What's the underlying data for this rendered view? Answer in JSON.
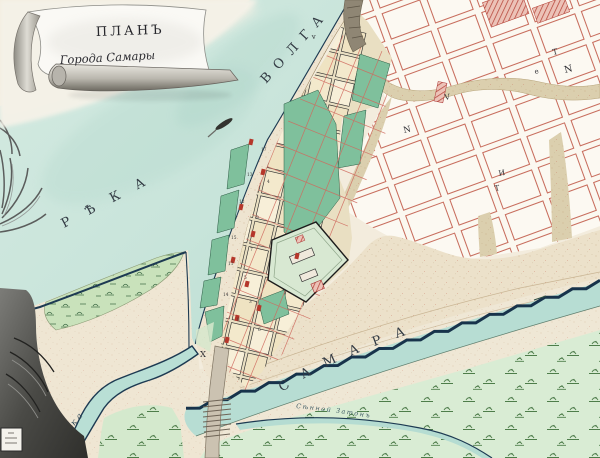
{
  "cartouche": {
    "title": "ПЛАНЪ",
    "subtitle": "Города Самары"
  },
  "labels": {
    "river_left_word": "РѢКА",
    "river_left_word2": "ВОЛГА",
    "river_bottom": "САМАРА",
    "channel_small": "рѣка",
    "backwater": "Сѣнной Затонъ"
  },
  "plot_letters": {
    "l1": "N",
    "l2": "Т",
    "l3": "е",
    "l4": "И",
    "l5": "Т",
    "l6": "N",
    "l7": "V",
    "l8": "v",
    "l9": "X"
  },
  "block_numbers": {
    "n1": "17",
    "n2": "13",
    "n3": "4",
    "n4": "12",
    "n5": "9",
    "n6": "15",
    "n7": "7",
    "n8": "11",
    "n9": "5",
    "n10": "14",
    "n11": "3",
    "n12": "8",
    "n13": "6"
  },
  "colors": {
    "paper": "#f3ecdd",
    "water": "#c8e4da",
    "water_deep": "#aed6ca",
    "bank_ink": "#1d3a52",
    "sand": "#eee4d0",
    "speckle": "#b98e63",
    "city_block": "#f5ecd3",
    "garden_green": "#7fc09c",
    "meadow": "#d9ecd4",
    "marsh": "#c9e2bb",
    "tuft_green": "#4e7d4a",
    "plan_red": "#c86e5e",
    "building_red": "#b5372b",
    "ravine": "#dbcfae",
    "road": "#cbc2b1",
    "ink": "#2e2e33"
  }
}
